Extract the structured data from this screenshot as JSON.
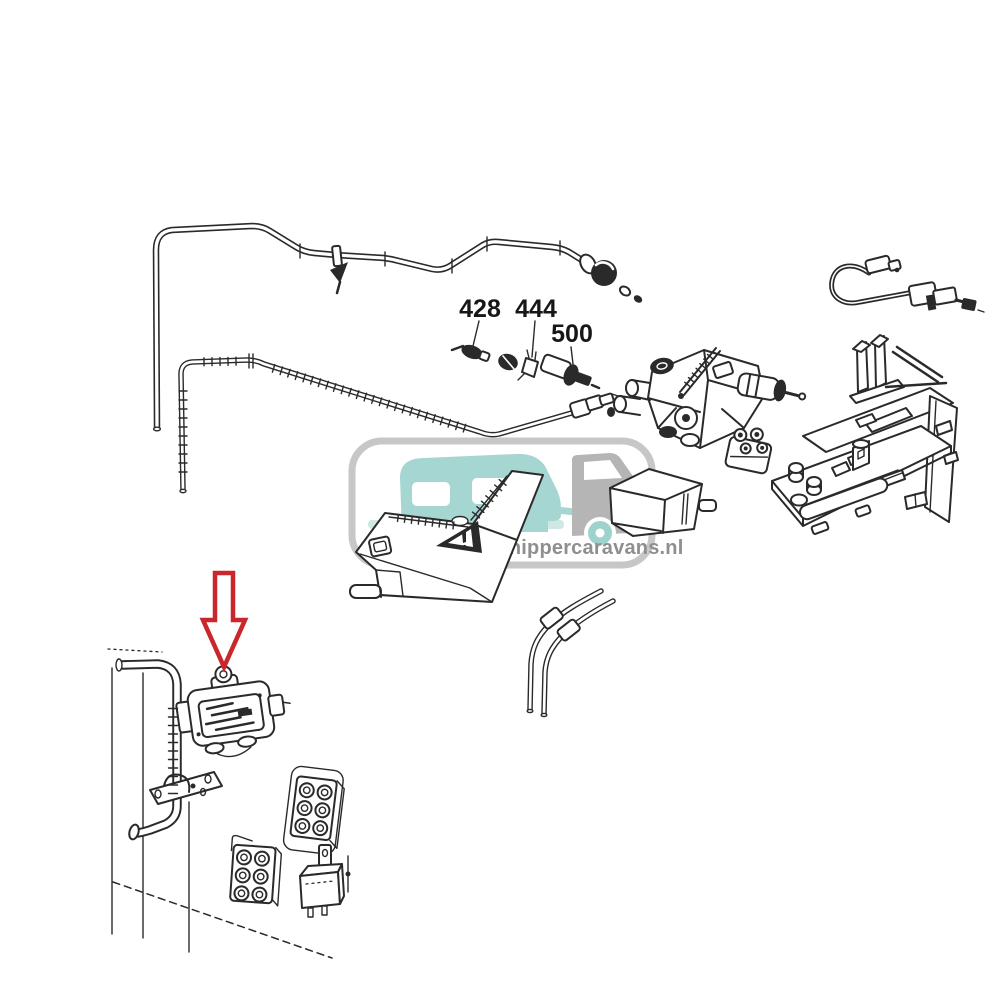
{
  "canvas": {
    "background": "#ffffff",
    "line_color": "#2a2a2a"
  },
  "watermark": {
    "text": "Schippercaravans.nl",
    "text_color": "#8f8f8f",
    "border_color": "#c7c7c7",
    "caravan_color": "#a6d6d1",
    "ground_color": "#cfe8e4",
    "van_color": "#b5b5b5",
    "wheel_color": "#9ed3cd",
    "headlight_color": "#efe08d"
  },
  "part_labels": {
    "p428": "428",
    "p444": "444",
    "p500": "500"
  },
  "annotation": {
    "arrow_color": "#c9272b"
  }
}
